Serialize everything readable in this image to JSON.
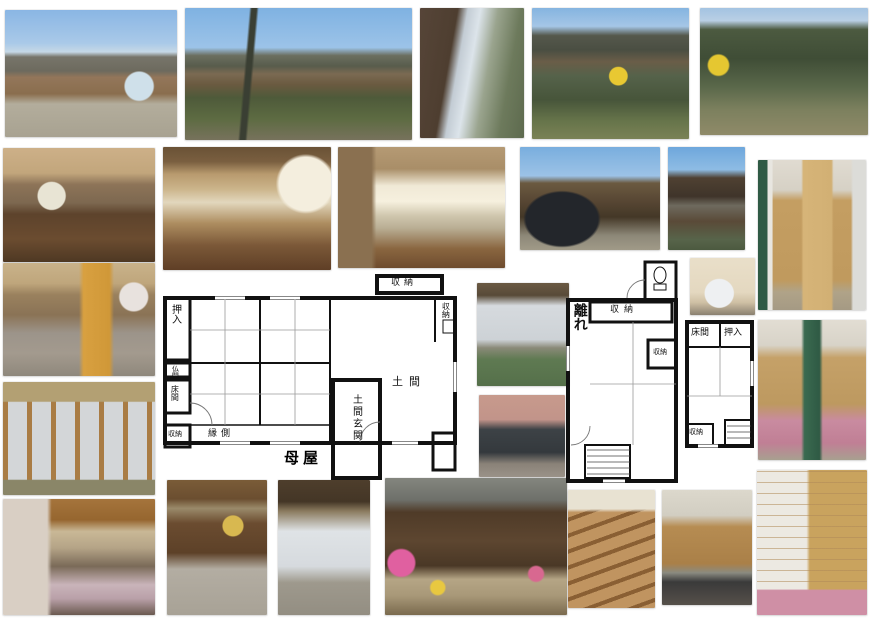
{
  "page": {
    "background": "#ffffff"
  },
  "floor_plans": {
    "main": {
      "title": "母屋",
      "labels": {
        "oshiire": "押入",
        "butsuma": "仏間",
        "tokonoma": "床間",
        "storage_sw": "収納",
        "engawa": "縁側",
        "doma_genkan": "土間玄関",
        "doma": "土間",
        "storage_top": "収納",
        "storage_right": "収納"
      },
      "wall_color": "#111111"
    },
    "hanare": {
      "title": "離れ",
      "labels": {
        "storage_top": "収納",
        "storage_mid": "収納",
        "tokonoma": "床間",
        "oshiire": "押入",
        "storage_bottom": "収納"
      },
      "wall_color": "#111111"
    }
  },
  "photos": [
    {
      "id": "exterior-approach",
      "desc": "Main house exterior with tiled roof and gravel approach"
    },
    {
      "id": "exterior-garden-view",
      "desc": "House exterior seen across the front garden"
    },
    {
      "id": "side-path",
      "desc": "Narrow path along the side of the building"
    },
    {
      "id": "garden-forsythia",
      "desc": "Garden with yellow forsythia and main house"
    },
    {
      "id": "garden-trees",
      "desc": "Garden with pine trees and shrubs"
    },
    {
      "id": "living-room",
      "desc": "Living room with wooden floor and refrigerator"
    },
    {
      "id": "dining-room",
      "desc": "Dining room with table and cupboards"
    },
    {
      "id": "dining-kitchen",
      "desc": "Dining kitchen with counter and bright window"
    },
    {
      "id": "carport-exterior",
      "desc": "Exterior with parked car under the eaves"
    },
    {
      "id": "storehouse-exterior",
      "desc": "Two-story storehouse exterior"
    },
    {
      "id": "western-room-door",
      "desc": "Western room with wooden door"
    },
    {
      "id": "poster-room",
      "desc": "Room with calendar and posters on the wall"
    },
    {
      "id": "tatami-shoji-room",
      "desc": "Tatami room with frosted glass sliding doors"
    },
    {
      "id": "laundry-room",
      "desc": "Laundry room with frosted window"
    },
    {
      "id": "bathroom",
      "desc": "Bathroom with dark bathtub"
    },
    {
      "id": "toilet",
      "desc": "Toilet"
    },
    {
      "id": "futon-room",
      "desc": "Tatami room with futon and shelves"
    },
    {
      "id": "veranda-room",
      "desc": "Tatami room with shoji doors open to veranda"
    },
    {
      "id": "bedroom",
      "desc": "Bedroom with floral curtain"
    },
    {
      "id": "doma-entrance",
      "desc": "Earthen-floor entrance hall"
    },
    {
      "id": "shoji-entrance",
      "desc": "Entrance with shoji screen door"
    },
    {
      "id": "front-entrance-flowers",
      "desc": "Front entrance with potted flowers"
    },
    {
      "id": "staircase",
      "desc": "Wooden staircase"
    },
    {
      "id": "upstairs-office",
      "desc": "Upstairs room with office desk"
    }
  ]
}
